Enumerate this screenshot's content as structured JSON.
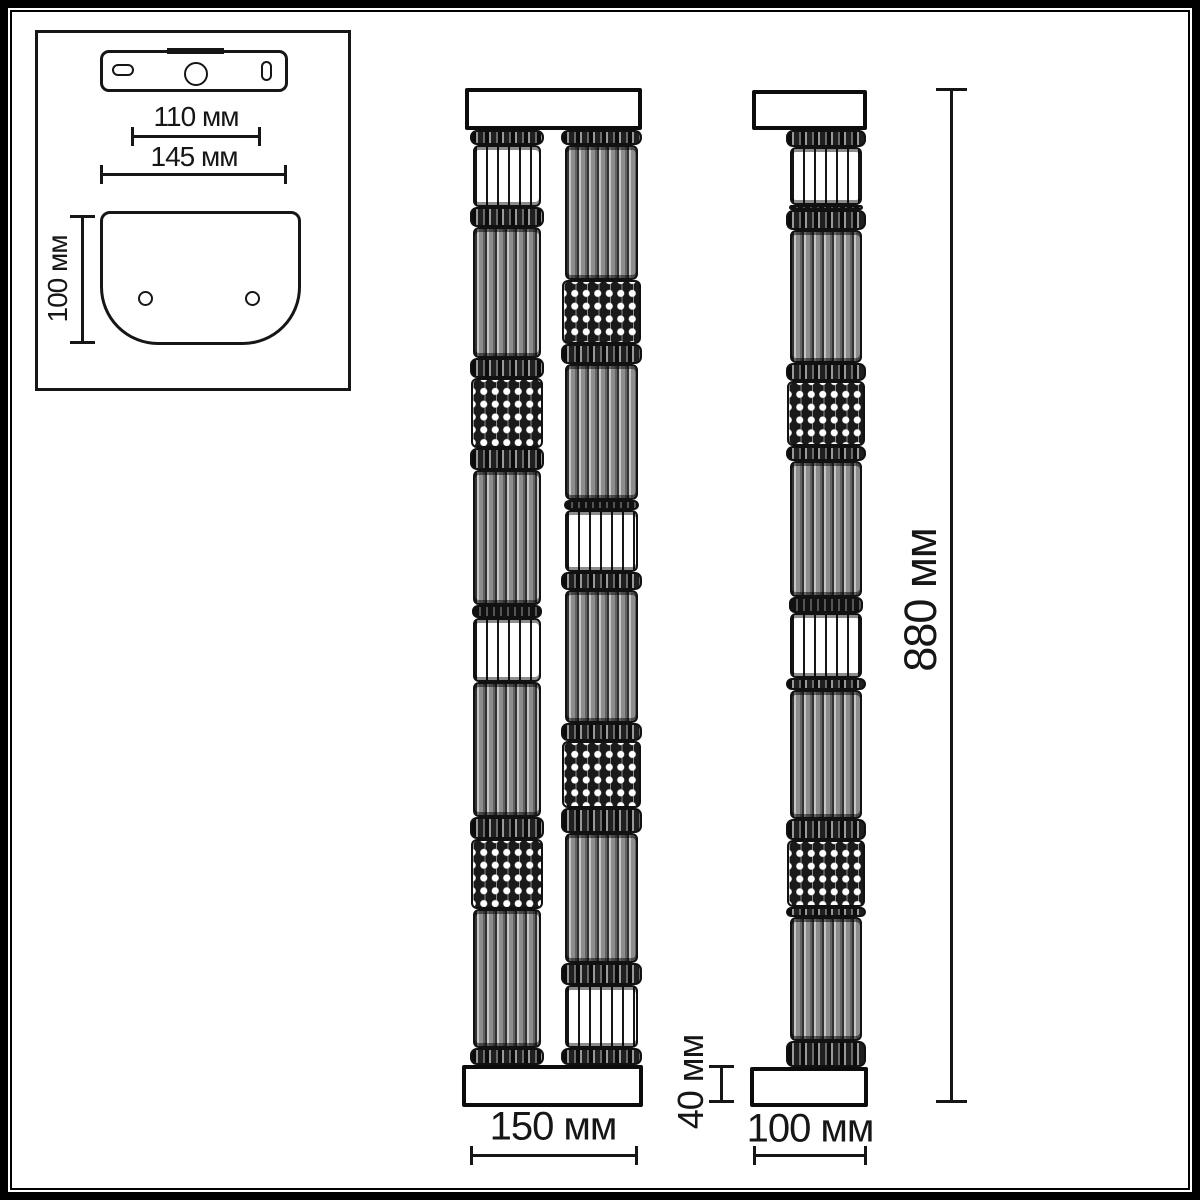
{
  "labels": {
    "inset_hole_spacing": "110 мм",
    "inset_bracket_width": "145 мм",
    "inset_plate_height": "100 мм",
    "front_width": "150 мм",
    "cap_height": "40 мм",
    "side_depth": "100 мм",
    "total_height": "880 мм"
  },
  "colors": {
    "line": "#161616",
    "background": "#ffffff",
    "gray_fill": "#8d8d8d",
    "dark_fill": "#1a1a1a"
  },
  "columns": {
    "front_left": [
      [
        "joint",
        15
      ],
      [
        "white",
        62
      ],
      [
        "ring",
        20
      ],
      [
        "gray",
        130
      ],
      [
        "ring",
        20
      ],
      [
        "dots",
        70
      ],
      [
        "ring",
        22
      ],
      [
        "gray",
        135
      ],
      [
        "thin",
        12
      ],
      [
        "white",
        64
      ],
      [
        "gray",
        135
      ],
      [
        "ring",
        22
      ],
      [
        "dots",
        70
      ],
      [
        "gray",
        138
      ],
      [
        "joint",
        17
      ]
    ],
    "front_right": [
      [
        "joint",
        15
      ],
      [
        "gray",
        135
      ],
      [
        "dots",
        64
      ],
      [
        "ring",
        20
      ],
      [
        "gray",
        136
      ],
      [
        "thin",
        10
      ],
      [
        "white",
        62
      ],
      [
        "ring",
        18
      ],
      [
        "gray",
        132
      ],
      [
        "ring",
        18
      ],
      [
        "dots",
        67
      ],
      [
        "ring",
        25
      ],
      [
        "gray",
        130
      ],
      [
        "ring",
        22
      ],
      [
        "white",
        63
      ],
      [
        "joint",
        17
      ]
    ],
    "side": [
      [
        "joint",
        16
      ],
      [
        "white",
        57
      ],
      [
        "thin",
        5
      ],
      [
        "ring",
        19
      ],
      [
        "gray",
        129
      ],
      [
        "ring",
        17
      ],
      [
        "dots",
        63
      ],
      [
        "ring",
        15
      ],
      [
        "gray",
        132
      ],
      [
        "thin",
        15
      ],
      [
        "white",
        63
      ],
      [
        "ring",
        12
      ],
      [
        "gray",
        125
      ],
      [
        "ring",
        20
      ],
      [
        "dots",
        65
      ],
      [
        "ring",
        10
      ],
      [
        "gray",
        120
      ],
      [
        "ring",
        25
      ]
    ]
  }
}
